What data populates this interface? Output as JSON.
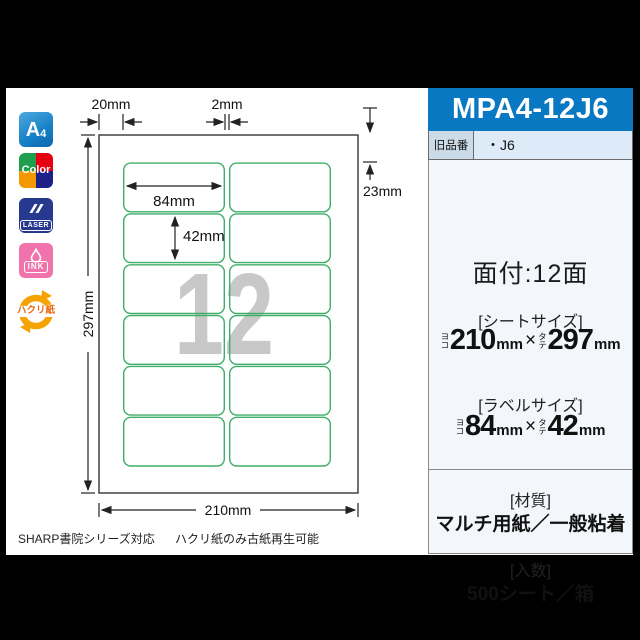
{
  "colors": {
    "title_bar_blue": "#0878c2",
    "label_green": "#3fae68",
    "watermark_gray": "#c8c8c8",
    "icon_a4_blue": "#1580c6",
    "icon_color_green": "#1f9e4c",
    "icon_color_red": "#e60012",
    "icon_color_orange": "#f39800",
    "icon_color_navy": "#1d2088",
    "icon_laser_navy": "#26398f",
    "icon_ink_pink": "#f173ac",
    "icon_recycle_orange": "#f5a300"
  },
  "icons": {
    "a4": {
      "main": "A",
      "sub": "4"
    },
    "color": {
      "label": "Color"
    },
    "laser": {
      "label": "LASER"
    },
    "ink": {
      "label": "INK"
    },
    "recycle": {
      "label": "ハクリ紙"
    }
  },
  "diagram": {
    "watermark": "12",
    "grid": {
      "rows": 6,
      "columns": 2
    },
    "dims": {
      "left_margin": "20mm",
      "column_gap": "2mm",
      "top_margin": "23mm",
      "sheet_height": "297mm",
      "sheet_width": "210mm",
      "label_width": "84mm",
      "label_height": "42mm"
    }
  },
  "footer": {
    "left_note": "SHARP書院シリーズ対応",
    "right_note": "ハクリ紙のみ古紙再生可能"
  },
  "panel": {
    "model_number": "MPA4-12J6",
    "old_model": {
      "label": "旧品番",
      "value": "・J6"
    },
    "imposition": "面付:12面",
    "sheet_size": {
      "heading": "[シートサイズ]",
      "width_prefix": "ヨコ",
      "width": "210",
      "times": "×",
      "height_prefix": "タテ",
      "height": "297",
      "unit": "mm"
    },
    "label_size": {
      "heading": "[ラベルサイズ]",
      "width_prefix": "ヨコ",
      "width": "84",
      "times": "×",
      "height_prefix": "タテ",
      "height": "42",
      "unit": "mm"
    },
    "material": {
      "heading": "[材質]",
      "value": "マルチ用紙／一般粘着"
    },
    "quantity": {
      "heading": "[入数]",
      "value": "500シート／箱"
    }
  }
}
